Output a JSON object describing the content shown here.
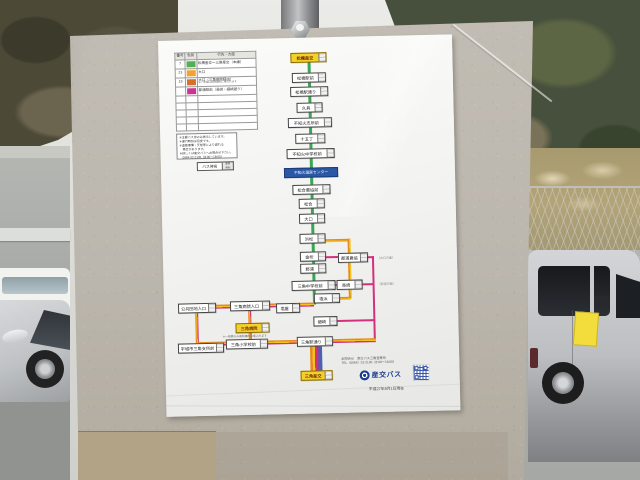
{
  "poster": {
    "legend": {
      "headers": [
        "番号",
        "色別",
        "行先・方面"
      ],
      "rows": [
        {
          "no": "7",
          "color": "#52b152",
          "label": "松橋産交～三角産交（本線）",
          "sub": ""
        },
        {
          "no": "23",
          "color": "#f2a32c",
          "label": "大口",
          "sub": ""
        },
        {
          "no": "15",
          "color": "#d9702a",
          "label": "大口（三角病院経由）",
          "sub": "※一部便は病院構内に乗入れます"
        },
        {
          "no": "",
          "color": "#c8368f",
          "label": "郡浦経由（長崎・細崎廻り）",
          "sub": ""
        }
      ]
    },
    "notes": {
      "line1": "※主要バス停のみ表示しています。",
      "line2": "※運行時刻は目安です。",
      "line3": "※道路事情・天候等により遅れる",
      "line4": "　場合があります。",
      "line5": "※詳しくは産交バスへお問合せ下さい。",
      "line6": "　0964-52-2135（8:00～18:00）"
    },
    "stop_sample": {
      "label": "バス停名",
      "fare": "運賃",
      "time": "時刻"
    },
    "route": {
      "main_stops": [
        {
          "name": "松橋産交"
        },
        {
          "name": "松橋駅前"
        },
        {
          "name": "松橋駅通り"
        },
        {
          "name": "久具"
        },
        {
          "name": "不知火支所前"
        },
        {
          "name": "十五丁"
        },
        {
          "name": "不知火中学校前"
        },
        {
          "name": "不知火温泉センター"
        },
        {
          "name": "松合農協前"
        },
        {
          "name": "松合"
        },
        {
          "name": "大口"
        },
        {
          "name": "浜松"
        },
        {
          "name": "金桁"
        },
        {
          "name": "郡浦"
        },
        {
          "name": "三角中学校前"
        }
      ],
      "branch_stops": [
        {
          "name": "郡浦農協"
        },
        {
          "name": "長崎"
        }
      ],
      "bottom_stops": [
        {
          "name": "公共団地入口"
        },
        {
          "name": "三角病院入口"
        },
        {
          "name": "塩屋"
        },
        {
          "name": "塩浜"
        },
        {
          "name": "細崎"
        },
        {
          "name": "三角病院",
          "sub": "※一部便のみ病院構内に乗入れます"
        },
        {
          "name": "宇城市三角支所前"
        },
        {
          "name": "三角小学校前"
        },
        {
          "name": "三角駅通り"
        },
        {
          "name": "三角産交"
        }
      ],
      "annotations": [
        {
          "text": "（大口方面）"
        },
        {
          "text": "（郡浦方面）"
        }
      ]
    },
    "footer": {
      "contact_line1": "お問合せ　産交バス三角営業所",
      "contact_line2": "TEL（0964）52-2135（8:00～18:00）",
      "logo_text": "産交バス",
      "date_text": "平成27年8月1日現在"
    }
  },
  "colors": {
    "route_green": "#3aa655",
    "route_orange": "#e8891d",
    "route_yellow": "#f0c420",
    "route_pink": "#d4317c",
    "route_purple": "#7a4fa0",
    "highlight_yellow": "#f2d12c",
    "highlight_blue": "#2b57a7"
  }
}
